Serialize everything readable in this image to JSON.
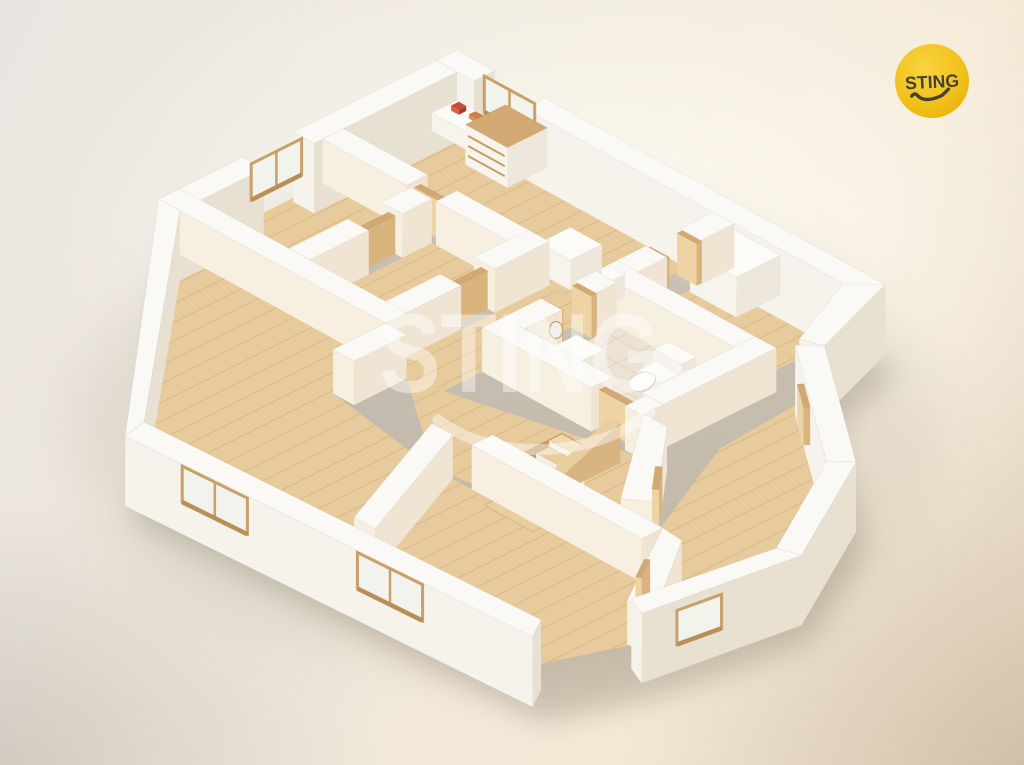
{
  "logo": {
    "text": "STING",
    "circle_color": "#f2c11c",
    "circle_color_light": "#f8d53f",
    "circle_color_deep": "#eab30d",
    "text_color": "#454136"
  },
  "watermark": {
    "text": "STING",
    "color": "rgba(255,255,255,0.42)"
  },
  "colors": {
    "wall_top": "#fbf9f5",
    "wall_sw": "#f6f2ec",
    "wall_se": "#e8e0d0",
    "inner_warm": "#f7efe0",
    "inner_cool": "#efe5d2",
    "white_top": "#fcfbf8",
    "white_sw": "#f7f4ee",
    "white_se": "#eee8dc",
    "wood_top": "#d2a873",
    "wood_sw": "#eed4a4",
    "wood_se": "#d9b47c",
    "floor_wood": "#e8cb9c",
    "plank_line": "#c49a66",
    "floor_tile": "#ece3d4",
    "tile_line": "#cbb493",
    "glass": "#f3f3ed",
    "frame": "#c8a069",
    "stair_well": "#c39a6a",
    "shadow": "#857a67"
  },
  "floorplan": {
    "projection": {
      "origin": [
        457,
        94
      ],
      "u_axis": [
        42,
        23
      ],
      "v_axis": [
        -42,
        21
      ],
      "wall_height": 44,
      "slab_depth": 26
    },
    "footprint": [
      [
        0,
        0
      ],
      [
        10.2,
        0
      ],
      [
        10.9,
        2.15
      ],
      [
        13.9,
        4.4
      ],
      [
        15.4,
        7.2
      ],
      [
        14.9,
        10.5
      ],
      [
        14.2,
        12.4
      ],
      [
        5.0,
        12.9
      ],
      [
        0,
        7.1
      ]
    ],
    "floors": [
      {
        "n": "floor-kitchen",
        "r": [
          0.5,
          0.5,
          6.6,
          3.2
        ],
        "m": "wood"
      },
      {
        "n": "floor-room-topleft",
        "r": [
          0.5,
          3.7,
          2.6,
          6.6
        ],
        "m": "wood"
      },
      {
        "n": "floor-room-top2",
        "r": [
          3.1,
          3.7,
          4.9,
          6.6
        ],
        "m": "wood"
      },
      {
        "n": "floor-room-right",
        "r": [
          7.1,
          0.5,
          9.9,
          2.8
        ],
        "m": "wood"
      },
      {
        "n": "floor-bathroom",
        "r": [
          7.1,
          3.3,
          9.9,
          5.5
        ],
        "m": "tile"
      },
      {
        "n": "floor-hall-north",
        "r": [
          5.4,
          3.2,
          6.6,
          7.1
        ],
        "m": "wood"
      },
      {
        "n": "floor-hall-south",
        "p": [
          [
            5.9,
            7.1
          ],
          [
            10.4,
            5.95
          ],
          [
            12.0,
            8.15
          ],
          [
            8.25,
            8.8
          ]
        ],
        "m": "wood"
      },
      {
        "n": "floor-living",
        "p": [
          [
            0.5,
            7.1
          ],
          [
            5.4,
            7.1
          ],
          [
            5.4,
            8.35
          ],
          [
            8.2,
            8.8
          ],
          [
            9.45,
            11.9
          ],
          [
            4.9,
            12.35
          ]
        ],
        "m": "wood"
      },
      {
        "n": "floor-room-bottommiddle",
        "p": [
          [
            8.7,
            8.8
          ],
          [
            13.2,
            8.8
          ],
          [
            14.5,
            10.35
          ],
          [
            13.9,
            11.9
          ],
          [
            9.45,
            11.9
          ]
        ],
        "m": "wood"
      },
      {
        "n": "floor-room-bottomright",
        "p": [
          [
            10.9,
            2.7
          ],
          [
            13.6,
            4.75
          ],
          [
            14.9,
            7.15
          ],
          [
            14.4,
            10.0
          ],
          [
            12.2,
            7.4
          ],
          [
            11.05,
            4.8
          ]
        ],
        "m": "wood"
      }
    ],
    "elements": [
      {
        "t": "wall",
        "n": "wall-ne-outer-a",
        "r": [
          0,
          0,
          0.9,
          0.5
        ],
        "ext": 1
      },
      {
        "t": "wall",
        "n": "wall-ne-outer-b",
        "r": [
          2.1,
          0,
          10.2,
          0.5
        ],
        "ext": 1
      },
      {
        "t": "win",
        "n": "kitchen-window",
        "a": [
          0.9,
          0.25
        ],
        "b": [
          2.1,
          0.25
        ],
        "t0": 0,
        "t1": 1,
        "z0": 8,
        "z1": 44,
        "panes": 2
      },
      {
        "t": "wall",
        "n": "wall-nw-outer-a",
        "r": [
          0,
          0.5,
          0.5,
          3.9
        ],
        "ext": 1
      },
      {
        "t": "wall",
        "n": "wall-nw-outer-b",
        "r": [
          0,
          5.1,
          0.5,
          7.1
        ],
        "ext": 1
      },
      {
        "t": "win",
        "n": "room-topleft-window",
        "a": [
          0.25,
          3.95
        ],
        "b": [
          0.25,
          5.15
        ],
        "t0": 0,
        "t1": 1,
        "z0": 8,
        "z1": 44,
        "panes": 2
      },
      {
        "t": "prism",
        "n": "kitchen-counter",
        "r": [
          0.55,
          0.55,
          1.65,
          1.15
        ],
        "z0": 0,
        "z1": 18,
        "white": 1
      },
      {
        "t": "prism",
        "n": "counter-item-red",
        "r": [
          0.72,
          0.68,
          0.9,
          0.86
        ],
        "z0": 18,
        "z1": 23,
        "cols": {
          "top": "#c84b3a",
          "sw": "#d95f4a",
          "se": "#a93a2c"
        }
      },
      {
        "t": "prism",
        "n": "counter-item-orange",
        "r": [
          1.1,
          0.66,
          1.35,
          0.82
        ],
        "z0": 18,
        "z1": 22,
        "cols": {
          "top": "#cf7f3f",
          "sw": "#dd9355",
          "se": "#b06a31"
        }
      },
      {
        "t": "prism",
        "n": "kitchen-cabinet",
        "r": [
          1.7,
          0.55,
          2.7,
          1.5
        ],
        "z0": 0,
        "z1": 40,
        "white": 1,
        "woodtop": 1
      },
      {
        "t": "line",
        "n": "cabinet-drawer-1",
        "a": [
          1.78,
          1.5,
          10
        ],
        "b": [
          2.62,
          1.5,
          10
        ],
        "w": 2,
        "col": "#c89c62"
      },
      {
        "t": "line",
        "n": "cabinet-drawer-2",
        "a": [
          1.78,
          1.5,
          20
        ],
        "b": [
          2.62,
          1.5,
          20
        ],
        "w": 2,
        "col": "#c89c62"
      },
      {
        "t": "line",
        "n": "cabinet-drawer-3",
        "a": [
          1.78,
          1.5,
          30
        ],
        "b": [
          2.62,
          1.5,
          30
        ],
        "w": 2,
        "col": "#c89c62"
      },
      {
        "t": "wall",
        "n": "wall-east-rightwing",
        "p": [
          [
            10.2,
            0
          ],
          [
            10.9,
            2.15
          ],
          [
            10.45,
            2.3
          ],
          [
            9.7,
            0.5
          ]
        ],
        "ext": 1
      },
      {
        "t": "prism",
        "n": "rightroom-closet",
        "r": [
          7.15,
          0.55,
          8.25,
          1.6
        ],
        "z0": 0,
        "z1": 40,
        "white": 1
      },
      {
        "t": "wall",
        "n": "wall-kitchen-east-a",
        "r": [
          6.6,
          0.5,
          7.1,
          1.3
        ]
      },
      {
        "t": "prism",
        "n": "doorframe-kitchen-east-1",
        "r": [
          6.62,
          1.25,
          7.08,
          1.38
        ],
        "z0": 0,
        "z1": 42,
        "wood": 1
      },
      {
        "t": "prism",
        "n": "doorframe-kitchen-east-2",
        "r": [
          6.62,
          2.02,
          7.08,
          2.15
        ],
        "z0": 0,
        "z1": 42,
        "wood": 1
      },
      {
        "t": "wall",
        "n": "wall-kitchen-east-b",
        "r": [
          6.6,
          2.1,
          7.1,
          3.2
        ]
      },
      {
        "t": "wall",
        "n": "wall-rightroom-south",
        "r": [
          6.6,
          2.8,
          10.4,
          3.3
        ]
      },
      {
        "t": "prism",
        "n": "boiler",
        "r": [
          6.2,
          2.55,
          6.55,
          3.0
        ],
        "z0": 0,
        "z1": 24,
        "white": 1
      },
      {
        "t": "prism",
        "n": "kitchen-island",
        "r": [
          5.0,
          2.3,
          5.75,
          3.05
        ],
        "z0": 0,
        "z1": 30,
        "white": 1
      },
      {
        "t": "wall",
        "n": "wall-mid-a",
        "r": [
          0.5,
          3.2,
          2.5,
          3.7
        ]
      },
      {
        "t": "prism",
        "n": "door-mid",
        "r": [
          2.5,
          3.36,
          3.2,
          3.52
        ],
        "z0": 0,
        "z1": 38,
        "wood": 1
      },
      {
        "t": "wall",
        "n": "wall-mid-b",
        "r": [
          3.2,
          3.2,
          5.4,
          3.7
        ]
      },
      {
        "t": "prism",
        "n": "toilet-tank",
        "r": [
          8.5,
          3.45,
          9.15,
          3.8
        ],
        "z0": 0,
        "z1": 20,
        "white": 1
      },
      {
        "t": "prism",
        "n": "toilet-base",
        "r": [
          8.55,
          3.8,
          9.1,
          4.25
        ],
        "z0": 0,
        "z1": 9,
        "white": 1
      },
      {
        "t": "ellipse",
        "n": "toilet-bowl",
        "c": [
          8.82,
          4.42,
          8
        ],
        "rx": 14,
        "ry": 9,
        "rot": -20,
        "fill": "#fcfbf8",
        "stroke": "#ddd5c6"
      },
      {
        "t": "prism",
        "n": "shower-tray",
        "r": [
          9.35,
          3.35,
          9.95,
          4.1
        ],
        "z0": 0,
        "z1": 3,
        "cols": {
          "top": "#efe9dd",
          "sw": "#f3eee4",
          "se": "#e2dacb"
        }
      },
      {
        "t": "line",
        "n": "shower-handle",
        "a": [
          9.93,
          3.5,
          30
        ],
        "b": [
          9.93,
          3.64,
          15
        ],
        "w": 2.5,
        "col": "#5f584c"
      },
      {
        "t": "wall",
        "n": "wall-r1-r2-a",
        "r": [
          2.6,
          3.7,
          3.1,
          4.4
        ]
      },
      {
        "t": "prism",
        "n": "door-r1-r2",
        "r": [
          2.77,
          4.4,
          2.93,
          5.2
        ],
        "z0": 0,
        "z1": 38,
        "wood": 1
      },
      {
        "t": "wall",
        "n": "wall-r1-r2-b",
        "r": [
          2.6,
          5.2,
          3.1,
          6.6
        ]
      },
      {
        "t": "wall",
        "n": "wall-r2-east-a",
        "r": [
          4.9,
          3.2,
          5.4,
          4.5
        ]
      },
      {
        "t": "prism",
        "n": "door-r2-east",
        "r": [
          5.07,
          4.5,
          5.23,
          5.3
        ],
        "z0": 0,
        "z1": 38,
        "wood": 1
      },
      {
        "t": "wall",
        "n": "wall-r2-east-b",
        "r": [
          4.9,
          5.3,
          5.4,
          7.1
        ]
      },
      {
        "t": "wall",
        "n": "wall-bath-east",
        "r": [
          9.9,
          2.8,
          10.4,
          5.5
        ]
      },
      {
        "t": "wall",
        "n": "wall-bath-west-a",
        "r": [
          6.6,
          3.3,
          7.1,
          3.8
        ]
      },
      {
        "t": "prism",
        "n": "doorframe-bath-1",
        "r": [
          6.62,
          3.75,
          7.08,
          3.88
        ],
        "z0": 0,
        "z1": 42,
        "wood": 1
      },
      {
        "t": "prism",
        "n": "doorframe-bath-2",
        "r": [
          6.62,
          4.55,
          7.08,
          4.68
        ],
        "z0": 0,
        "z1": 42,
        "wood": 1
      },
      {
        "t": "wall",
        "n": "wall-bath-west-b",
        "r": [
          6.6,
          4.6,
          7.1,
          6.0
        ]
      },
      {
        "t": "prism",
        "n": "bath-vanity",
        "r": [
          7.15,
          4.3,
          7.8,
          5.05
        ],
        "z0": 0,
        "z1": 14,
        "white": 1
      },
      {
        "t": "ellipse",
        "n": "bath-mirror",
        "c": [
          7.08,
          4.72,
          26
        ],
        "rx": 6.5,
        "ry": 8.5,
        "rot": 0,
        "fill": "#eef0ed",
        "stroke": "#c8a069"
      },
      {
        "t": "wall",
        "n": "wall-bath-south-a",
        "r": [
          6.6,
          5.5,
          9.2,
          6.0
        ]
      },
      {
        "t": "prism",
        "n": "door-bath-south",
        "r": [
          9.2,
          5.66,
          10.0,
          5.82
        ],
        "z0": 0,
        "z1": 38,
        "wood": 1
      },
      {
        "t": "wall",
        "n": "wall-bath-south-b",
        "r": [
          10.0,
          5.5,
          10.4,
          6.0
        ]
      },
      {
        "t": "wall",
        "n": "wall-br-ne",
        "p": [
          [
            10.9,
            2.15
          ],
          [
            13.9,
            4.4
          ],
          [
            13.55,
            4.75
          ],
          [
            10.55,
            2.5
          ]
        ],
        "ext": 1
      },
      {
        "t": "prism",
        "n": "door-br-ne",
        "p": [
          [
            11.39,
            3.13
          ],
          [
            11.99,
            3.58
          ],
          [
            11.92,
            3.67
          ],
          [
            11.32,
            3.22
          ]
        ],
        "z0": 0,
        "z1": 38,
        "wood": 1
      },
      {
        "t": "wall",
        "n": "wall-band-r1r2-living",
        "r": [
          0,
          6.6,
          5.4,
          7.1
        ]
      },
      {
        "t": "wall",
        "n": "wall-br-se",
        "p": [
          [
            13.9,
            4.4
          ],
          [
            15.4,
            7.2
          ],
          [
            14.95,
            7.35
          ],
          [
            13.55,
            4.75
          ]
        ],
        "ext": 1
      },
      {
        "t": "stairs",
        "n": "staircase",
        "u1": 8.85,
        "u2": 10.0,
        "v0": 6.35,
        "v1": 8.2,
        "steps": 6
      },
      {
        "t": "rail",
        "n": "stair-railing",
        "x": 10.0,
        "w": 0.24,
        "v0": 6.35,
        "v1": 8.2,
        "z0": 40,
        "z1": 8
      },
      {
        "t": "wall",
        "n": "wall-living-east",
        "r": [
          5.4,
          7.1,
          5.9,
          8.35
        ]
      },
      {
        "t": "wall",
        "n": "wall-lobby",
        "p": [
          [
            10.4,
            5.95
          ],
          [
            10.95,
            5.95
          ],
          [
            12.55,
            7.8
          ],
          [
            12.05,
            8.15
          ]
        ]
      },
      {
        "t": "prism",
        "n": "door-lobby",
        "p": [
          [
            11.67,
            6.78
          ],
          [
            12.15,
            7.34
          ],
          [
            12.06,
            7.42
          ],
          [
            11.58,
            6.86
          ]
        ],
        "z0": 0,
        "z1": 38,
        "wood": 1
      },
      {
        "t": "wall",
        "n": "wall-r7-north",
        "r": [
          9.15,
          8.3,
          13.2,
          8.8
        ]
      },
      {
        "t": "wall",
        "n": "wall-r7-west",
        "p": [
          [
            8.2,
            8.8
          ],
          [
            8.7,
            8.8
          ],
          [
            9.95,
            11.9
          ],
          [
            9.45,
            11.9
          ]
        ]
      },
      {
        "t": "wall",
        "n": "wall-r7-east",
        "p": [
          [
            13.2,
            8.3
          ],
          [
            13.7,
            8.35
          ],
          [
            14.95,
            10.2
          ],
          [
            14.45,
            10.4
          ]
        ]
      },
      {
        "t": "prism",
        "n": "door-r7-east",
        "p": [
          [
            13.64,
            9.04
          ],
          [
            13.95,
            9.56
          ],
          [
            13.87,
            9.62
          ],
          [
            13.56,
            9.1
          ]
        ],
        "z0": 0,
        "z1": 38,
        "wood": 1
      },
      {
        "t": "wall",
        "n": "wall-br-sw",
        "p": [
          [
            15.4,
            7.2
          ],
          [
            14.9,
            10.5
          ],
          [
            14.45,
            10.3
          ],
          [
            14.95,
            7.35
          ]
        ],
        "ext": 1
      },
      {
        "t": "win",
        "n": "br-door-recess",
        "a": [
          15.4,
          7.2
        ],
        "b": [
          14.9,
          10.5
        ],
        "t0": 0.5,
        "t1": 0.78,
        "z0": 0,
        "z1": 34,
        "panes": 1
      },
      {
        "t": "wall",
        "n": "wall-nw-shear",
        "p": [
          [
            0,
            7.1
          ],
          [
            0.5,
            7.1
          ],
          [
            4.9,
            12.35
          ],
          [
            5.0,
            12.9
          ]
        ],
        "ext": 1
      },
      {
        "t": "wall",
        "n": "wall-sw-band",
        "p": [
          [
            5.0,
            12.9
          ],
          [
            14.2,
            12.4
          ],
          [
            13.9,
            11.9
          ],
          [
            4.9,
            12.35
          ]
        ],
        "ext": 1
      },
      {
        "t": "win",
        "n": "living-window",
        "a": [
          5.0,
          12.9
        ],
        "b": [
          14.2,
          12.4
        ],
        "t0": 0.14,
        "t1": 0.3,
        "z0": 6,
        "z1": 42,
        "panes": 2
      },
      {
        "t": "win",
        "n": "bottommiddle-window",
        "a": [
          5.0,
          12.9
        ],
        "b": [
          14.2,
          12.4
        ],
        "t0": 0.57,
        "t1": 0.73,
        "z0": 6,
        "z1": 42,
        "panes": 2
      }
    ]
  }
}
